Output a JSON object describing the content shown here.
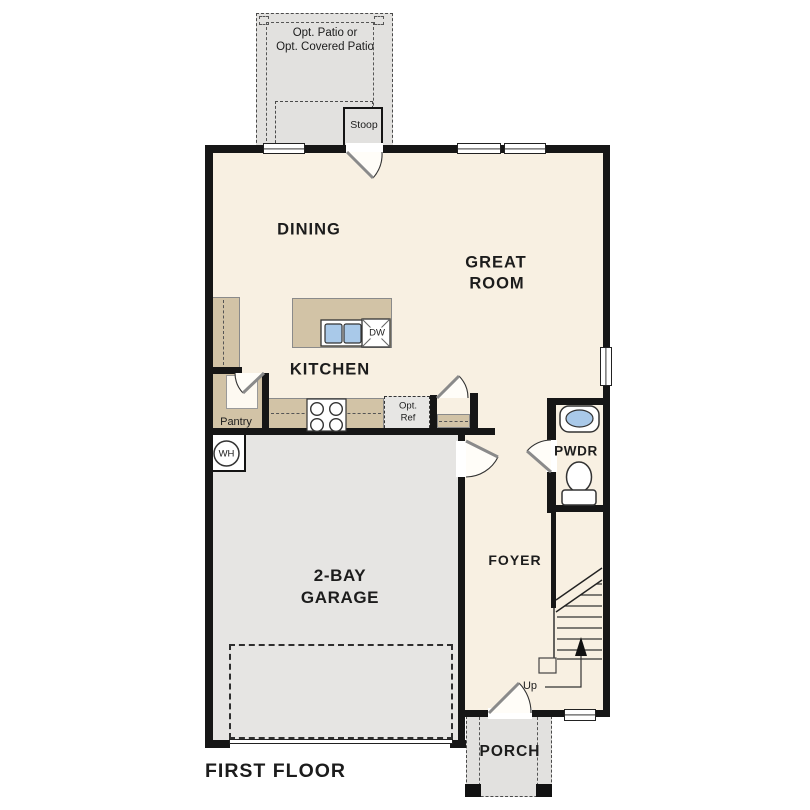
{
  "plan_title": "FIRST FLOOR",
  "rooms": {
    "dining": "DINING",
    "great_room": [
      "GREAT",
      "ROOM"
    ],
    "kitchen": "KITCHEN",
    "foyer": "FOYER",
    "powder": "PWDR",
    "porch": "PORCH",
    "garage": [
      "2-BAY",
      "GARAGE"
    ],
    "pantry": "Pantry"
  },
  "outdoor": {
    "patio": [
      "Opt. Patio or",
      "Opt. Covered Patio"
    ],
    "stoop": "Stoop"
  },
  "annotations": {
    "up": "Up",
    "water_heater": "WH",
    "dishwasher": "DW",
    "opt_ref": [
      "Opt.",
      "Ref"
    ]
  },
  "colors": {
    "wall": "#161616",
    "interior_floor": "#f8f0e2",
    "garage_floor": "#e6e5e3",
    "outdoor_floor": "#e2e1df",
    "counter": "#d2c3a6",
    "fixture_blue": "#a9c9e9"
  }
}
